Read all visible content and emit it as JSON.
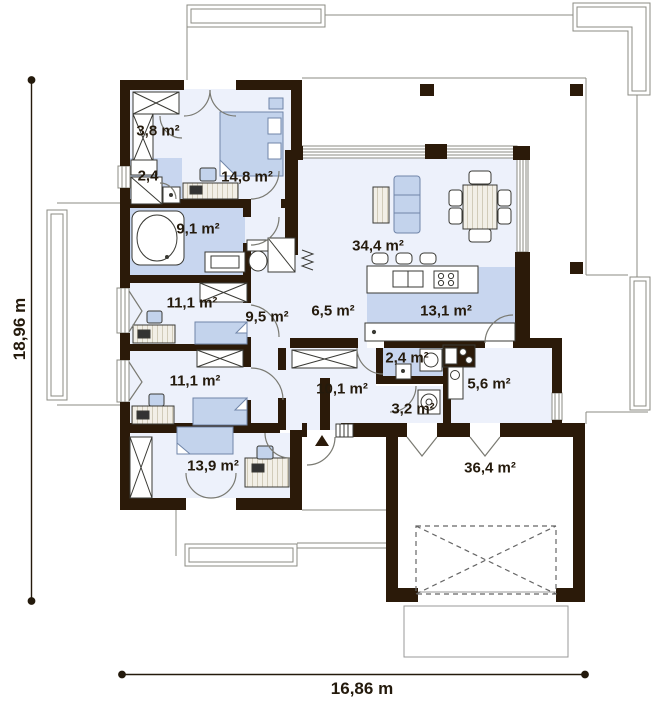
{
  "plan": {
    "title": "single-storey house floor plan",
    "dimensions": {
      "height_label": "18,96 m",
      "width_label": "16,86 m"
    },
    "rooms": [
      {
        "id": "wardrobe",
        "area_label": "3,8 m²"
      },
      {
        "id": "bathroom-small",
        "area_label": "2,4"
      },
      {
        "id": "bedroom-1",
        "area_label": "14,8 m²"
      },
      {
        "id": "bathroom-main",
        "area_label": "9,1 m²"
      },
      {
        "id": "bedroom-2",
        "area_label": "11,1 m²"
      },
      {
        "id": "hallway",
        "area_label": "9,5 m²"
      },
      {
        "id": "corridor",
        "area_label": "6,5 m²"
      },
      {
        "id": "living-room",
        "area_label": "34,4 m²"
      },
      {
        "id": "kitchen",
        "area_label": "13,1 m²"
      },
      {
        "id": "laundry",
        "area_label": "2,4 m²"
      },
      {
        "id": "pantry",
        "area_label": "5,6 m²"
      },
      {
        "id": "hall",
        "area_label": "10,1 m²"
      },
      {
        "id": "wc",
        "area_label": "3,2 m²"
      },
      {
        "id": "bedroom-3",
        "area_label": "11,1 m²"
      },
      {
        "id": "bedroom-4",
        "area_label": "13,9 m²"
      },
      {
        "id": "garage",
        "area_label": "36,4 m²"
      }
    ],
    "colors": {
      "wall": "#2b1a09",
      "floor_light": "#edf1fb",
      "floor_blue": "#c8d6ef",
      "furniture_blue": "#c3d3ec"
    }
  }
}
